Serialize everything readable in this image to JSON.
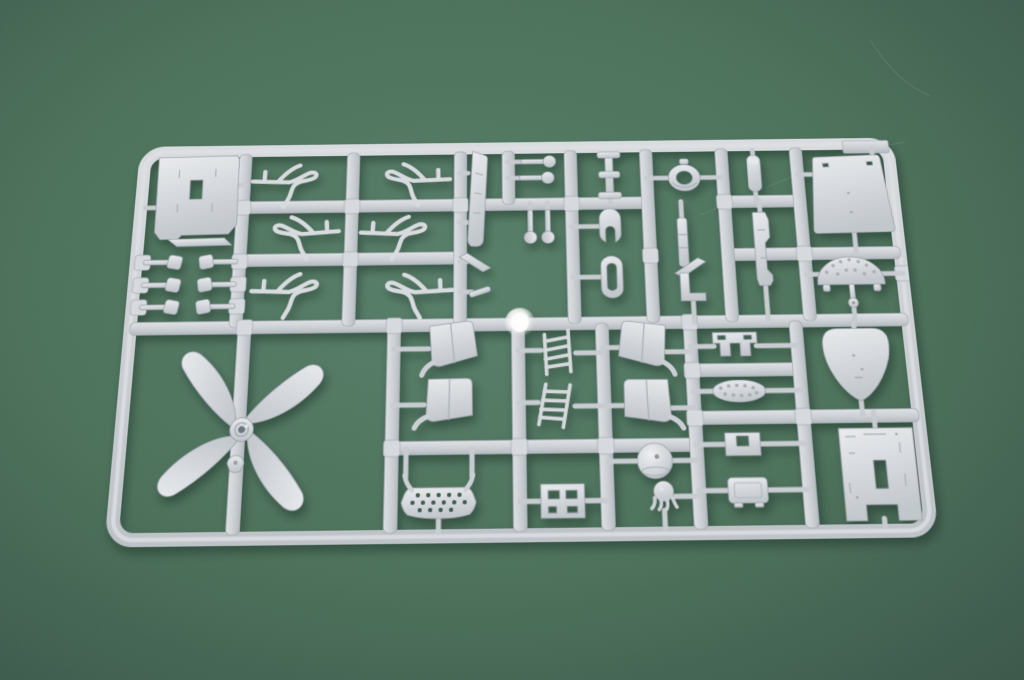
{
  "scene": {
    "subject": "photograph of a light-gray plastic injection-molded model kit sprue (parts frame) lying on dark green textured paper, lit from upper right, slight perspective tilt",
    "colors": {
      "background_center": "#567e69",
      "background_mid": "#4b7059",
      "background_edge": "#3a574a",
      "plastic_highlight": "#e9ebee",
      "plastic_base": "#d2d5d9",
      "plastic_shadow": "#b9bfc5",
      "plastic_outline": "#9aa2a9",
      "cast_shadow": "rgba(20,38,30,0.45)",
      "gate_shine": "#ffffff"
    },
    "sprue": {
      "frame": {
        "x": 6.5,
        "y": 6.5,
        "w": 779,
        "h": 395,
        "rx": 20,
        "thickness": 13
      },
      "corner_tab": {
        "x": 738,
        "y": 3,
        "w": 48,
        "h": 14
      },
      "gate": {
        "x": 397,
        "y": 194
      },
      "runners_h": [
        [
          196,
          6,
          786
        ],
        [
          69,
          112,
          337
        ],
        [
          126,
          112,
          337
        ],
        [
          69,
          360,
          531
        ],
        [
          69,
          610,
          688
        ],
        [
          126,
          610,
          786
        ],
        [
          318,
          271,
          567
        ],
        [
          245,
          567,
          673
        ],
        [
          292,
          567,
          786
        ]
      ],
      "runners_v": [
        [
          112,
          10,
          196
        ],
        [
          225,
          10,
          196
        ],
        [
          337,
          10,
          196
        ],
        [
          387,
          10,
          69
        ],
        [
          452,
          10,
          196
        ],
        [
          531,
          10,
          196
        ],
        [
          610,
          10,
          196
        ],
        [
          688,
          10,
          196
        ],
        [
          121,
          196,
          398
        ],
        [
          271,
          196,
          398
        ],
        [
          395,
          196,
          398
        ],
        [
          479,
          196,
          398
        ],
        [
          567,
          196,
          398
        ],
        [
          673,
          196,
          398
        ]
      ],
      "pads": [
        [
          13,
          127
        ],
        [
          13,
          151
        ],
        [
          13,
          174
        ],
        [
          112,
          127
        ],
        [
          112,
          151
        ],
        [
          112,
          174
        ],
        [
          112,
          69
        ],
        [
          225,
          69
        ],
        [
          337,
          69
        ],
        [
          225,
          126
        ],
        [
          452,
          69
        ],
        [
          531,
          126
        ],
        [
          610,
          69
        ],
        [
          688,
          126
        ],
        [
          271,
          318
        ],
        [
          395,
          318
        ],
        [
          479,
          318
        ],
        [
          567,
          245
        ],
        [
          567,
          292
        ],
        [
          673,
          292
        ],
        [
          121,
          196
        ],
        [
          271,
          196
        ],
        [
          567,
          196
        ],
        [
          786,
          148
        ]
      ],
      "stubs": [
        [
          104,
          44,
          114,
          44
        ],
        [
          24,
          68,
          11,
          68
        ],
        [
          345,
          34,
          336,
          34
        ],
        [
          345,
          88,
          336,
          88
        ],
        [
          404,
          22,
          386,
          22
        ],
        [
          402,
          40,
          386,
          40
        ],
        [
          409,
          80,
          409,
          68
        ],
        [
          427,
          80,
          427,
          68
        ],
        [
          492,
          14,
          492,
          20
        ],
        [
          492,
          56,
          492,
          70
        ],
        [
          531,
          42,
          554,
          42
        ],
        [
          586,
          42,
          611,
          42
        ],
        [
          451,
          94,
          481,
          94
        ],
        [
          451,
          148,
          481,
          148
        ],
        [
          565,
          68,
          565,
          88
        ],
        [
          572,
          172,
          572,
          197
        ],
        [
          643,
          12,
          643,
          20
        ],
        [
          643,
          56,
          643,
          70
        ],
        [
          646,
          68,
          646,
          84
        ],
        [
          646,
          156,
          646,
          197
        ],
        [
          688,
          40,
          708,
          40
        ],
        [
          741,
          104,
          741,
          127
        ],
        [
          768,
          22,
          768,
          11
        ],
        [
          688,
          148,
          701,
          148
        ],
        [
          764,
          148,
          786,
          148
        ],
        [
          733,
          178,
          733,
          197
        ],
        [
          337,
          130,
          345,
          130
        ],
        [
          337,
          162,
          349,
          162
        ],
        [
          271,
          220,
          306,
          220
        ],
        [
          271,
          276,
          302,
          276
        ],
        [
          479,
          221,
          499,
          221
        ],
        [
          479,
          279,
          501,
          279
        ],
        [
          542,
          226,
          568,
          226
        ],
        [
          545,
          282,
          568,
          282
        ],
        [
          395,
          223,
          418,
          223
        ],
        [
          395,
          275,
          414,
          275
        ],
        [
          452,
          226,
          480,
          226
        ],
        [
          450,
          279,
          480,
          279
        ],
        [
          285,
          346,
          285,
          319
        ],
        [
          349,
          346,
          349,
          319
        ],
        [
          317,
          386,
          317,
          398
        ],
        [
          395,
          370,
          416,
          370
        ],
        [
          458,
          370,
          480,
          370
        ],
        [
          481,
          333,
          510,
          333
        ],
        [
          543,
          333,
          567,
          333
        ],
        [
          541,
          367,
          567,
          367
        ],
        [
          533,
          380,
          533,
          397
        ],
        [
          567,
          221,
          590,
          221
        ],
        [
          632,
          221,
          673,
          221
        ],
        [
          567,
          266,
          587,
          266
        ],
        [
          637,
          266,
          673,
          266
        ],
        [
          567,
          318,
          596,
          318
        ],
        [
          628,
          318,
          673,
          318
        ],
        [
          567,
          362,
          596,
          362
        ],
        [
          632,
          362,
          673,
          362
        ],
        [
          731,
          196,
          731,
          206
        ],
        [
          731,
          276,
          731,
          290
        ],
        [
          742,
          288,
          742,
          306
        ],
        [
          742,
          390,
          742,
          397
        ]
      ],
      "parts": [
        {
          "t": "plate",
          "x": 64,
          "y": 56,
          "r": -1
        },
        {
          "t": "clip",
          "x": 31,
          "y": 127
        },
        {
          "t": "clip",
          "x": 31,
          "y": 151
        },
        {
          "t": "clip",
          "x": 31,
          "y": 174
        },
        {
          "t": "clip",
          "x": 93,
          "y": 127,
          "sx": -1
        },
        {
          "t": "clip",
          "x": 93,
          "y": 151,
          "sx": -1
        },
        {
          "t": "clip",
          "x": 93,
          "y": 174,
          "sx": -1
        },
        {
          "t": "wire",
          "x": 167,
          "y": 38,
          "r": 2
        },
        {
          "t": "wire",
          "x": 280,
          "y": 38,
          "sx": -1,
          "r": -2
        },
        {
          "t": "wire",
          "x": 166,
          "y": 95,
          "sx": -1,
          "r": -4
        },
        {
          "t": "wire",
          "x": 281,
          "y": 96,
          "r": 3
        },
        {
          "t": "wire",
          "x": 172,
          "y": 156,
          "r": 2
        },
        {
          "t": "wire",
          "x": 283,
          "y": 158,
          "sx": -1,
          "r": -3
        },
        {
          "t": "striplong",
          "x": 355,
          "y": 62,
          "r": 3
        },
        {
          "t": "pin",
          "x": 417,
          "y": 22
        },
        {
          "t": "pin",
          "x": 415,
          "y": 40
        },
        {
          "t": "pin",
          "x": 409,
          "y": 92,
          "r": 90
        },
        {
          "t": "pin",
          "x": 427,
          "y": 92,
          "r": 90
        },
        {
          "t": "spool",
          "x": 492,
          "y": 38
        },
        {
          "t": "ring",
          "x": 570,
          "y": 42
        },
        {
          "t": "pod",
          "x": 491,
          "y": 94
        },
        {
          "t": "ovalring",
          "x": 491,
          "y": 148
        },
        {
          "t": "strip",
          "x": 565,
          "y": 112
        },
        {
          "t": "angle",
          "x": 571,
          "y": 138
        },
        {
          "t": "lbr",
          "x": 572,
          "y": 160
        },
        {
          "t": "rod",
          "x": 643,
          "y": 38
        },
        {
          "t": "stack",
          "x": 646,
          "y": 120
        },
        {
          "t": "trap",
          "x": 741,
          "y": 62
        },
        {
          "t": "fan",
          "x": 733,
          "y": 146
        },
        {
          "t": "angle",
          "x": 352,
          "y": 130,
          "sx": -1
        },
        {
          "t": "bar",
          "x": 357,
          "y": 162,
          "r": -18
        },
        {
          "t": "prop",
          "x": 124,
          "y": 298,
          "r": 10
        },
        {
          "t": "spinner",
          "x": 120,
          "y": 331
        },
        {
          "t": "seat",
          "x": 329,
          "y": 222,
          "r": -3
        },
        {
          "t": "seat",
          "x": 325,
          "y": 278,
          "r": 4
        },
        {
          "t": "seat",
          "x": 520,
          "y": 224,
          "sx": -1,
          "r": 3
        },
        {
          "t": "seat",
          "x": 523,
          "y": 281,
          "sx": -1,
          "r": -4
        },
        {
          "t": "ladder",
          "x": 436,
          "y": 225,
          "r": -8
        },
        {
          "t": "ladder",
          "x": 432,
          "y": 278,
          "r": 5
        },
        {
          "t": "ovalholes",
          "x": 317,
          "y": 370
        },
        {
          "t": "slotbracket",
          "x": 436,
          "y": 370
        },
        {
          "t": "dome",
          "x": 526,
          "y": 333
        },
        {
          "t": "acorn",
          "x": 533,
          "y": 366
        },
        {
          "t": "hbracket",
          "x": 611,
          "y": 221
        },
        {
          "t": "ovaldots",
          "x": 612,
          "y": 266
        },
        {
          "t": "uchannel",
          "x": 612,
          "y": 318
        },
        {
          "t": "box",
          "x": 614,
          "y": 362
        },
        {
          "t": "heart",
          "x": 731,
          "y": 240
        },
        {
          "t": "panel",
          "x": 742,
          "y": 348
        }
      ],
      "part_legend": {
        "plate": "rectangular hatch plate with slot hole",
        "clip": "small bar clip with square block",
        "wire": "thin bent lever / linkage part",
        "striplong": "long narrow strip part",
        "pin": "pin with round ball head",
        "spool": "flanged spool part",
        "ring": "round grommet ring with center hole",
        "pod": "U-shaped pod part",
        "ovalring": "oblong ring with slot hole",
        "prop": "four-blade propeller with hub",
        "spinner": "propeller spinner cap",
        "seat": "curved seat-back panel with hook arm",
        "ladder": "small ladder / lattice frame",
        "ovalholes": "domed plate with perforated grid and curved arms",
        "slotbracket": "bracket plate with four slots",
        "dome": "dome bowl with top hole",
        "acorn": "acorn knob with drooping legs",
        "hbracket": "staple-shaped bracket with two slots",
        "ovaldots": "oval pad with dimple row",
        "uchannel": "U-channel clamp",
        "box": "small rectangular box part",
        "heart": "shield / teardrop shaped fairing",
        "panel": "detailed rectangular panel with notches",
        "trap": "large trapezoid deck panel",
        "fan": "semicircular dimpled instrument panel with stem disc",
        "rod": "rounded capped rod",
        "stack": "stepped vertical stack part",
        "angle": "small angled wedge",
        "lbr": "L-shaped bracket",
        "bar": "small plain bar",
        "strip": "short narrow strip"
      }
    }
  }
}
